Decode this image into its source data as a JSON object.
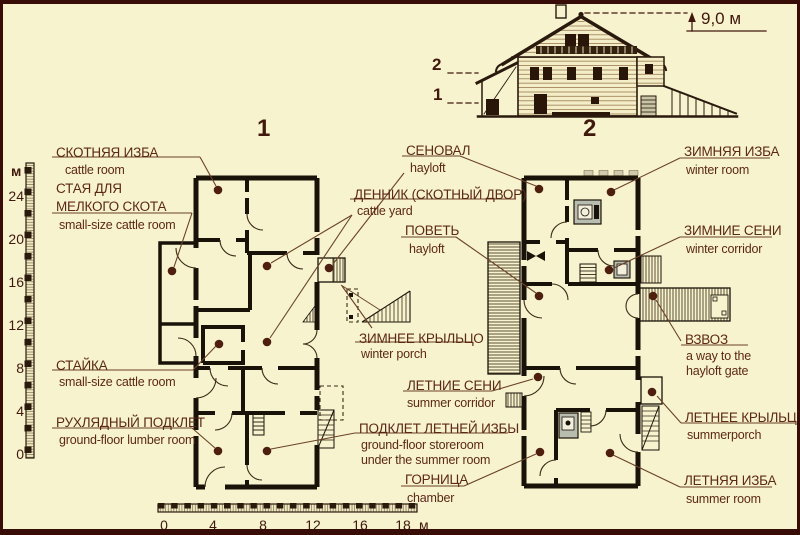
{
  "colors": {
    "background": "#f7f3cf",
    "frame": "#380d07",
    "ink": "#5e2817",
    "wall": "#191208",
    "leader": "#6b4226",
    "dot": "#4e1f0e",
    "stove_grey": "#b9bdb0"
  },
  "plan_titles": {
    "plan1": "1",
    "plan2": "2"
  },
  "elevation": {
    "height_label": "9,0 м",
    "upper_level": "2",
    "lower_level": "1",
    "section_label": "2"
  },
  "vscale": {
    "unit": "м",
    "ticks": [
      "24",
      "20",
      "16",
      "12",
      "8",
      "4",
      "0"
    ]
  },
  "hscale": {
    "unit": "м",
    "ticks": [
      "0",
      "4",
      "8",
      "12",
      "16",
      "18"
    ]
  },
  "labels": {
    "skotnya": {
      "ru": "СКОТНЯЯ ИЗБА",
      "en": "cattle room"
    },
    "staya": {
      "ru1": "СТАЯ ДЛЯ",
      "ru2": "МЕЛКОГО СКОТА",
      "en": "small-size cattle room"
    },
    "stayka": {
      "ru": "СТАЙКА",
      "en": "small-size cattle room"
    },
    "rukhlyadny": {
      "ru": "РУХЛЯДНЫЙ ПОДКЛЕТ",
      "en": "ground-floor lumber room"
    },
    "senoval": {
      "ru": "СЕНОВАЛ",
      "en": "hayloft"
    },
    "dennik": {
      "ru": "ДЕННИК (СКОТНЫЙ ДВОР)",
      "en": "cattle yard"
    },
    "povet": {
      "ru": "ПОВЕТЬ",
      "en": "hayloft"
    },
    "zimnee_kryltso": {
      "ru": "ЗИМНЕЕ КРЫЛЬЦО",
      "en": "winter porch"
    },
    "letnie_seni": {
      "ru": "ЛЕТНИЕ СЕНИ",
      "en": "summer corridor"
    },
    "podklet": {
      "ru": "ПОДКЛЕТ ЛЕТНЕЙ ИЗБЫ",
      "en1": "ground-floor storeroom",
      "en2": "under the summer room"
    },
    "gornitsa": {
      "ru": "ГОРНИЦА",
      "en": "chamber"
    },
    "zimnyaya_izba": {
      "ru": "ЗИМНЯЯ ИЗБА",
      "en": "winter room"
    },
    "zimnie_seni": {
      "ru": "ЗИМНИЕ СЕНИ",
      "en": "winter corridor"
    },
    "vzvoz": {
      "ru": "ВЗВОЗ",
      "en1": "a way to the",
      "en2": "hayloft gate"
    },
    "letnee_kryltso": {
      "ru": "ЛЕТНЕЕ КРЫЛЬЦО",
      "en": "summerporch"
    },
    "letnyaya_izba": {
      "ru": "ЛЕТНЯЯ ИЗБА",
      "en": "summer room"
    }
  }
}
